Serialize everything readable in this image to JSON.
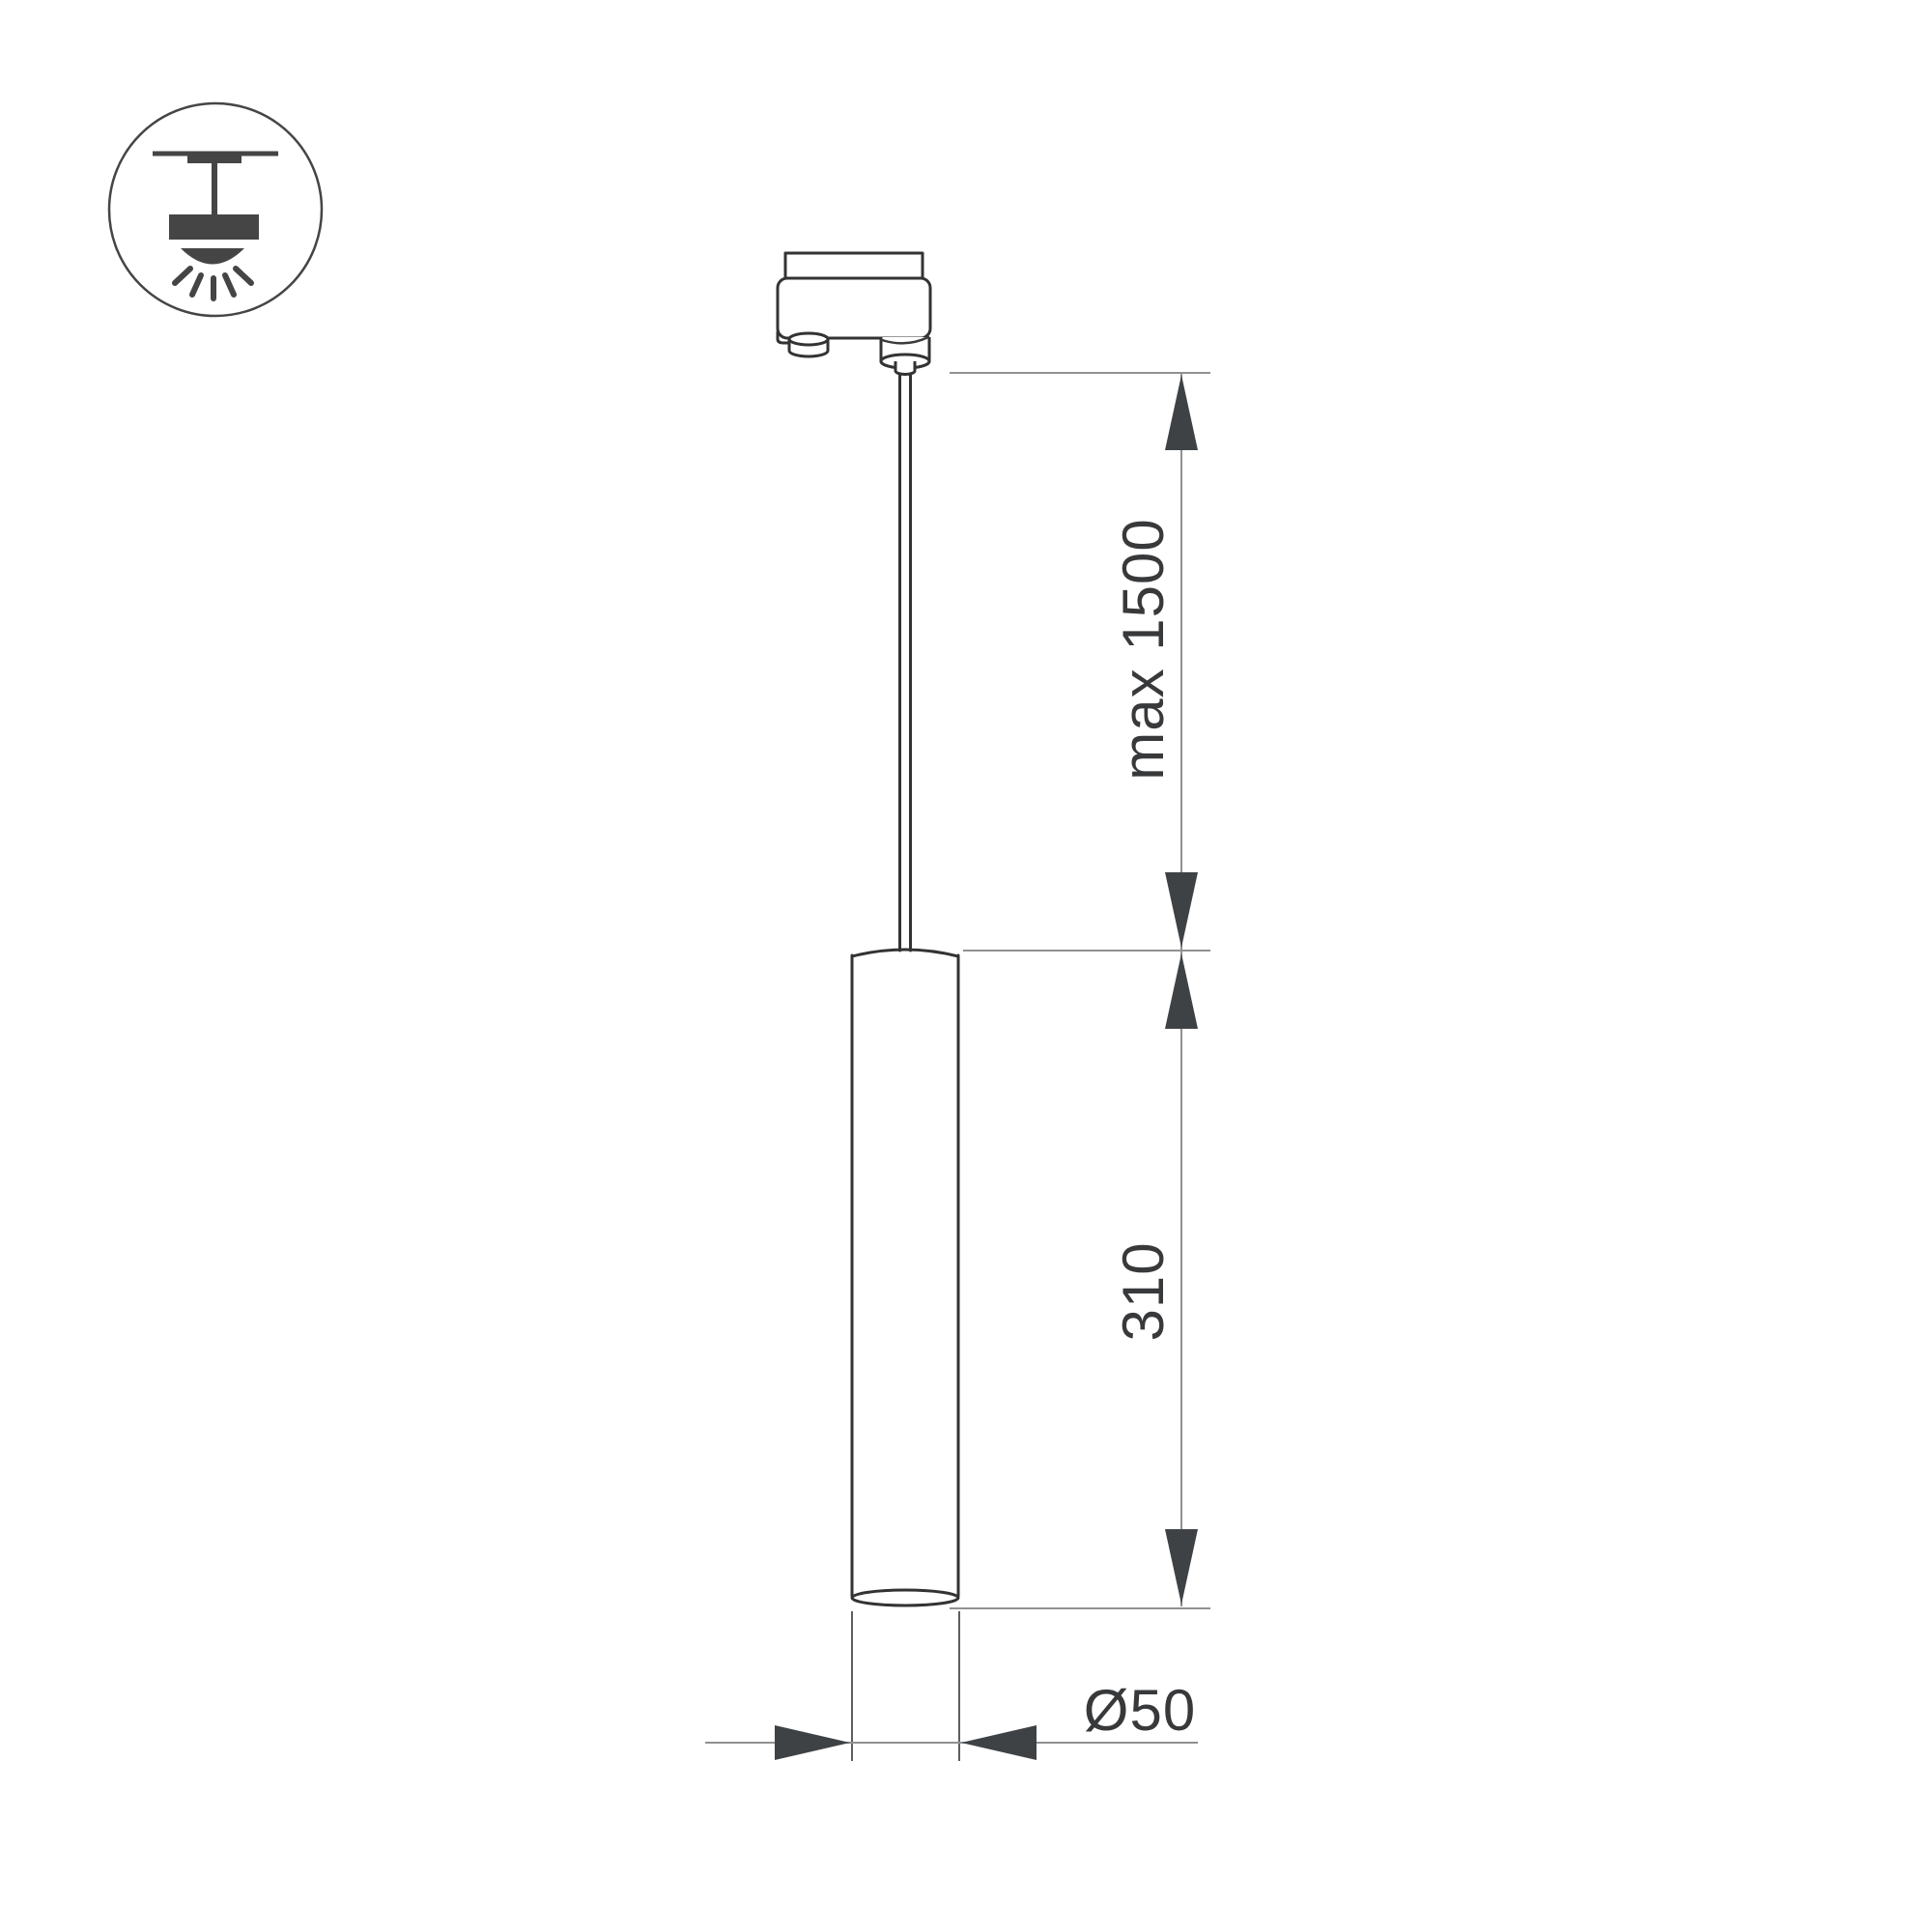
{
  "page": {
    "background": "#ffffff"
  },
  "legend_icon": {
    "name": "ceiling-pendant-mount-icon"
  },
  "colors": {
    "outline": "#333333",
    "dimension_line": "#919191",
    "extension_line": "#5e5e5e",
    "arrow": "#3f4245",
    "text": "#38393b",
    "icon": "#454545"
  },
  "dimensions": {
    "suspension": {
      "label": "max 1500"
    },
    "height": {
      "label": "310"
    },
    "diameter": {
      "label": "Ø50"
    }
  }
}
